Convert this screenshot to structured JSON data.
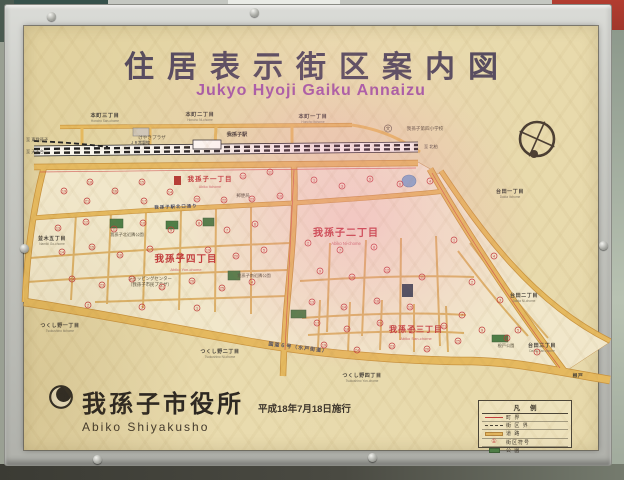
{
  "sign": {
    "title": "住居表示街区案内図",
    "subtitle": "Jukyo Hyoji Gaiku Annaizu",
    "publisher": {
      "name": "我孫子市役所",
      "romaji": "Abiko Shiyakusho",
      "date": "平成18年7月18日施行"
    },
    "legend": {
      "title": "凡例",
      "rows": [
        {
          "sym": "boundary",
          "label": "町 界"
        },
        {
          "sym": "block",
          "label": "街 区 界"
        },
        {
          "sym": "road",
          "label": "道 路"
        },
        {
          "sym": "number",
          "label": "街区符号",
          "glyph": "①"
        },
        {
          "sym": "park",
          "label": "公 園"
        }
      ]
    }
  },
  "colors": {
    "sign_background": "#e7d9ab",
    "road_fill": "#e2b55e",
    "district_label_red": "#c23b3b",
    "title_text": "#564b5f",
    "subtitle_text": "#a558a6",
    "park_green": "#4e7d46",
    "pond_blue": "#7fa8c9"
  },
  "map": {
    "railway_name": "ＪＲ常磐線",
    "station_name": "我孫子駅",
    "labels": [
      {
        "t": "我孫子一丁目",
        "x": 210,
        "y": 181,
        "c": "rd1",
        "s": 6.5
      },
      {
        "t": "Abiko Itchome",
        "x": 210,
        "y": 188,
        "c": "rdr",
        "s": 3.5
      },
      {
        "t": "我孫子二丁目",
        "x": 346,
        "y": 236,
        "c": "rd1",
        "s": 10
      },
      {
        "t": "Abiko Ni-chome",
        "x": 346,
        "y": 245,
        "c": "rdr",
        "s": 4.2
      },
      {
        "t": "我孫子三丁目",
        "x": 416,
        "y": 332,
        "c": "rd1",
        "s": 8
      },
      {
        "t": "Abiko San-chome",
        "x": 416,
        "y": 340,
        "c": "rdr",
        "s": 4
      },
      {
        "t": "我孫子四丁目",
        "x": 186,
        "y": 262,
        "c": "rd1",
        "s": 9.5
      },
      {
        "t": "Abiko Yon-chome",
        "x": 186,
        "y": 271,
        "c": "rdr",
        "s": 4
      },
      {
        "t": "本町三丁目",
        "x": 105,
        "y": 117,
        "c": "bd",
        "s": 5.2
      },
      {
        "t": "Honcho San-chome",
        "x": 105,
        "y": 122,
        "c": "rm",
        "s": 3.2
      },
      {
        "t": "本町二丁目",
        "x": 200,
        "y": 116,
        "c": "bd",
        "s": 5.2
      },
      {
        "t": "Honcho Ni-chome",
        "x": 200,
        "y": 121,
        "c": "rm",
        "s": 3.2
      },
      {
        "t": "本町一丁目",
        "x": 313,
        "y": 118,
        "c": "bd",
        "s": 5.2
      },
      {
        "t": "Honcho Itchome",
        "x": 313,
        "y": 123,
        "c": "rm",
        "s": 3.2
      },
      {
        "t": "台田一丁目",
        "x": 510,
        "y": 193,
        "c": "bd",
        "s": 5
      },
      {
        "t": "Daida Itchome",
        "x": 510,
        "y": 198,
        "c": "rm",
        "s": 3.2
      },
      {
        "t": "台田二丁目",
        "x": 524,
        "y": 297,
        "c": "bd",
        "s": 5
      },
      {
        "t": "Daida Ni-chome",
        "x": 524,
        "y": 302,
        "c": "rm",
        "s": 3.2
      },
      {
        "t": "台田三丁目",
        "x": 542,
        "y": 347,
        "c": "bd",
        "s": 5
      },
      {
        "t": "Daida San-chome",
        "x": 542,
        "y": 352,
        "c": "rm",
        "s": 3.2
      },
      {
        "t": "つくし野一丁目",
        "x": 60,
        "y": 327,
        "c": "bd",
        "s": 5
      },
      {
        "t": "Tsukushino Itchome",
        "x": 60,
        "y": 332,
        "c": "rm",
        "s": 3.2
      },
      {
        "t": "つくし野二丁目",
        "x": 220,
        "y": 353,
        "c": "bd",
        "s": 5
      },
      {
        "t": "Tsukushino Ni-chome",
        "x": 220,
        "y": 358,
        "c": "rm",
        "s": 3.2
      },
      {
        "t": "つくし野四丁目",
        "x": 362,
        "y": 377,
        "c": "bd",
        "s": 5
      },
      {
        "t": "Tsukushino Yon-chome",
        "x": 362,
        "y": 382,
        "c": "rm",
        "s": 3.2
      },
      {
        "t": "並木五丁目",
        "x": 52,
        "y": 240,
        "c": "bd",
        "s": 5
      },
      {
        "t": "Namiki Go-chome",
        "x": 52,
        "y": 245,
        "c": "rm",
        "s": 3.2
      },
      {
        "t": "根戸",
        "x": 578,
        "y": 377,
        "c": "bd",
        "s": 4.8
      },
      {
        "t": "けやきプラザ",
        "x": 152,
        "y": 139,
        "c": "fc",
        "s": 4.6
      },
      {
        "t": "我孫子第四小学校",
        "x": 425,
        "y": 130,
        "c": "fc",
        "s": 4.6
      },
      {
        "t": "文",
        "x": 388,
        "y": 130,
        "c": "fc",
        "s": 4.5
      },
      {
        "t": "郵便局",
        "x": 243,
        "y": 197,
        "c": "fc",
        "s": 4.4
      },
      {
        "t": "ショッピングセンター",
        "x": 150,
        "y": 280,
        "c": "fc",
        "s": 4.4
      },
      {
        "t": "（我孫子市民プラザ）",
        "x": 150,
        "y": 286,
        "c": "fc",
        "s": 4.4
      },
      {
        "t": "我孫子南近隣公園",
        "x": 254,
        "y": 277,
        "c": "fc",
        "s": 4.2
      },
      {
        "t": "我孫子北近隣公園",
        "x": 127,
        "y": 236,
        "c": "fc",
        "s": 4.2
      },
      {
        "t": "根戸公園",
        "x": 506,
        "y": 347,
        "c": "fc",
        "s": 4.2
      },
      {
        "t": "我孫子駅",
        "x": 237,
        "y": 136,
        "c": "st",
        "s": 5.2
      },
      {
        "t": "国道６号（水戸街道）",
        "x": 298,
        "y": 349,
        "c": "ro",
        "s": 5,
        "r": 7
      },
      {
        "t": "我孫子駅北口通り",
        "x": 176,
        "y": 208,
        "c": "ro",
        "s": 4.4,
        "r": -2
      },
      {
        "t": "ＪＲ常磐線",
        "x": 140,
        "y": 144,
        "c": "rw",
        "s": 4
      },
      {
        "t": "至 東我孫子",
        "x": 26,
        "y": 141,
        "c": "dir",
        "s": 4.2,
        "a": "start"
      },
      {
        "t": "至 天王台",
        "x": 26,
        "y": 153,
        "c": "dir",
        "s": 4.2,
        "a": "start"
      },
      {
        "t": "至 北柏",
        "x": 424,
        "y": 148,
        "c": "dir",
        "s": 4.2,
        "a": "start"
      }
    ],
    "markers": [
      [
        64,
        191,
        19
      ],
      [
        90,
        182,
        18
      ],
      [
        87,
        201,
        21
      ],
      [
        115,
        191,
        16
      ],
      [
        142,
        182,
        15
      ],
      [
        144,
        201,
        17
      ],
      [
        170,
        192,
        14
      ],
      [
        197,
        199,
        20
      ],
      [
        224,
        200,
        22
      ],
      [
        252,
        199,
        23
      ],
      [
        280,
        196,
        10
      ],
      [
        243,
        176,
        12
      ],
      [
        270,
        172,
        11
      ],
      [
        314,
        180,
        1
      ],
      [
        342,
        186,
        3
      ],
      [
        370,
        179,
        5
      ],
      [
        400,
        184,
        6
      ],
      [
        430,
        181,
        4
      ],
      [
        308,
        243,
        2
      ],
      [
        340,
        250,
        7
      ],
      [
        374,
        247,
        8
      ],
      [
        320,
        271,
        9
      ],
      [
        352,
        277,
        10
      ],
      [
        387,
        270,
        12
      ],
      [
        422,
        277,
        11
      ],
      [
        312,
        302,
        13
      ],
      [
        344,
        307,
        14
      ],
      [
        377,
        301,
        16
      ],
      [
        410,
        307,
        15
      ],
      [
        317,
        323,
        17
      ],
      [
        347,
        329,
        18
      ],
      [
        380,
        323,
        20
      ],
      [
        412,
        330,
        22
      ],
      [
        444,
        326,
        21
      ],
      [
        324,
        345,
        19
      ],
      [
        357,
        350,
        24
      ],
      [
        392,
        346,
        23
      ],
      [
        427,
        349,
        26
      ],
      [
        458,
        341,
        25
      ],
      [
        58,
        228,
        13
      ],
      [
        86,
        222,
        12
      ],
      [
        114,
        229,
        11
      ],
      [
        143,
        223,
        10
      ],
      [
        171,
        230,
        9
      ],
      [
        199,
        223,
        8
      ],
      [
        227,
        230,
        7
      ],
      [
        255,
        224,
        6
      ],
      [
        62,
        252,
        14
      ],
      [
        92,
        247,
        15
      ],
      [
        120,
        255,
        16
      ],
      [
        150,
        249,
        17
      ],
      [
        180,
        256,
        18
      ],
      [
        208,
        250,
        19
      ],
      [
        236,
        256,
        20
      ],
      [
        264,
        250,
        5
      ],
      [
        72,
        279,
        24
      ],
      [
        102,
        285,
        23
      ],
      [
        132,
        279,
        22
      ],
      [
        162,
        287,
        21
      ],
      [
        192,
        281,
        26
      ],
      [
        222,
        288,
        25
      ],
      [
        252,
        282,
        4
      ],
      [
        88,
        305,
        2
      ],
      [
        142,
        307,
        3
      ],
      [
        197,
        308,
        1
      ],
      [
        454,
        240,
        1
      ],
      [
        472,
        282,
        2
      ],
      [
        494,
        256,
        4
      ],
      [
        500,
        300,
        3
      ],
      [
        518,
        330,
        5
      ],
      [
        537,
        352,
        6
      ],
      [
        462,
        315,
        7
      ],
      [
        482,
        330,
        9
      ],
      [
        507,
        338,
        8
      ]
    ]
  }
}
